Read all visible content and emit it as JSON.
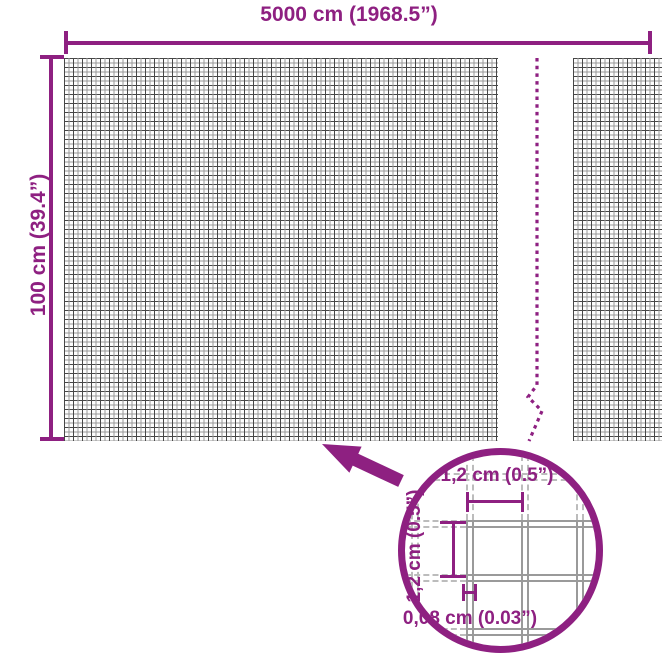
{
  "accent_color": "#8e2081",
  "mesh_color": "#474747",
  "diagram": {
    "product": "mesh-fence-roll-dimensions",
    "width_dim": {
      "label": "5000 cm (1968.5”)"
    },
    "height_dim": {
      "label": "100 cm (39.4”)"
    },
    "detail": {
      "cell_width": {
        "label": "1,2 cm (0.5”)"
      },
      "cell_height": {
        "label": "1,2 cm (0.5”)"
      },
      "wire_thickness": {
        "label": "0,08 cm (0.03”)"
      }
    }
  },
  "icons": {
    "arrow": "detail-arrow-icon",
    "break_line": "break-line-icon",
    "magnifier": "detail-circle"
  }
}
